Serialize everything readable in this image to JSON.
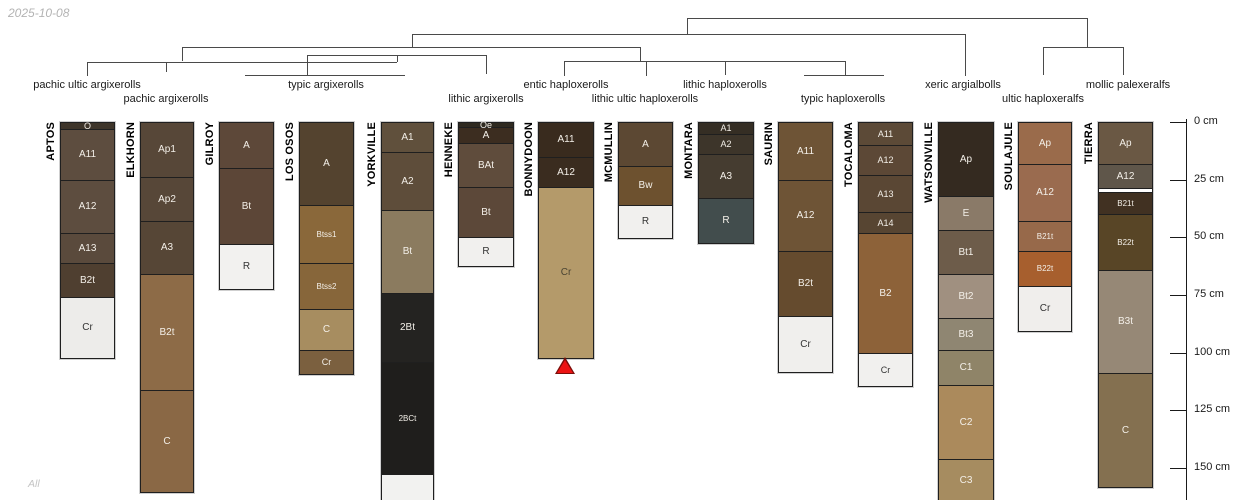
{
  "meta": {
    "date": "2025-10-08",
    "footer": "All"
  },
  "chart_data": {
    "type": "soil-profile-dendrogram",
    "title": "",
    "depth_axis": {
      "unit": "cm",
      "tick_values_cm": [
        0,
        25,
        50,
        75,
        100,
        125,
        150
      ],
      "tick_labels": [
        "0 cm",
        "25 cm",
        "50 cm",
        "75 cm",
        "100 cm",
        "125 cm",
        "150 cm"
      ]
    },
    "taxa": [
      {
        "label": "pachic ultic argixerolls",
        "x": 87,
        "row": 1,
        "members": [
          "APTOS"
        ]
      },
      {
        "label": "pachic argixerolls",
        "x": 166,
        "row": 2,
        "members": [
          "ELKHORN"
        ]
      },
      {
        "label": "typic argixerolls",
        "x": 326,
        "row": 1,
        "members": [
          "GILROY",
          "LOS OSOS",
          "YORKVILLE"
        ]
      },
      {
        "label": "lithic argixerolls",
        "x": 486,
        "row": 2,
        "members": [
          "HENNEKE"
        ]
      },
      {
        "label": "entic haploxerolls",
        "x": 566,
        "row": 1,
        "members": [
          "BONNYDOON"
        ]
      },
      {
        "label": "lithic ultic haploxerolls",
        "x": 645,
        "row": 2,
        "members": [
          "MCMULLIN"
        ]
      },
      {
        "label": "lithic haploxerolls",
        "x": 725,
        "row": 1,
        "members": [
          "MONTARA"
        ]
      },
      {
        "label": "typic haploxerolls",
        "x": 843,
        "row": 2,
        "members": [
          "SAURIN",
          "TOCALOMA"
        ]
      },
      {
        "label": "xeric argialbolls",
        "x": 963,
        "row": 1,
        "members": [
          "WATSONVILLE"
        ]
      },
      {
        "label": "ultic haploxeralfs",
        "x": 1043,
        "row": 2,
        "members": [
          "SOULAJULE"
        ]
      },
      {
        "label": "mollic palexeralfs",
        "x": 1128,
        "row": 1,
        "members": [
          "TIERRA"
        ]
      }
    ],
    "dendrogram": {
      "line_color": "#4a4a4a",
      "segments": [
        [
          87,
          61.5,
          397,
          61.5
        ],
        [
          307,
          55,
          486,
          55
        ],
        [
          182,
          47.3,
          640,
          47.3
        ],
        [
          564,
          61.3,
          845,
          61.3
        ],
        [
          412,
          33.5,
          965,
          33.5
        ],
        [
          687,
          18,
          1087,
          18
        ],
        [
          1043,
          47,
          1123,
          47
        ],
        [
          245,
          74.5,
          405,
          74.5
        ],
        [
          804,
          75,
          884,
          75
        ],
        [
          87,
          61.5,
          87,
          76
        ],
        [
          166,
          61.5,
          166,
          72
        ],
        [
          307,
          55,
          307,
          74.5
        ],
        [
          397,
          55,
          397,
          61.5
        ],
        [
          486,
          55,
          486,
          74
        ],
        [
          182,
          47.3,
          182,
          61.5
        ],
        [
          640,
          47.3,
          640,
          61.3
        ],
        [
          564,
          61.3,
          564,
          76
        ],
        [
          646,
          61.3,
          646,
          76
        ],
        [
          725,
          61.3,
          725,
          75
        ],
        [
          845,
          61.3,
          845,
          75
        ],
        [
          412,
          33.5,
          412,
          47.3
        ],
        [
          965,
          33.5,
          965,
          76
        ],
        [
          687,
          18,
          687,
          33.5
        ],
        [
          1087,
          18,
          1087,
          47
        ],
        [
          1043,
          47,
          1043,
          75
        ],
        [
          1123,
          47,
          1123,
          75
        ]
      ]
    },
    "marker": {
      "shape": "triangle-up",
      "fill": "#ec1313",
      "edge": "#7a0e0a",
      "profile": "BONNYDOON",
      "x": 565,
      "y": 357
    },
    "profiles": [
      {
        "name": "APTOS",
        "x": 60,
        "width": 53,
        "clipped": false,
        "horizons": [
          {
            "label": "O",
            "top_cm": 0,
            "bottom_cm": 3,
            "color": "#3e352a",
            "font": 9
          },
          {
            "label": "A11",
            "top_cm": 3,
            "bottom_cm": 25,
            "color": "#5d4d3f"
          },
          {
            "label": "A12",
            "top_cm": 25,
            "bottom_cm": 48,
            "color": "#5d4d3f"
          },
          {
            "label": "A13",
            "top_cm": 48,
            "bottom_cm": 61,
            "color": "#5a4a3c"
          },
          {
            "label": "B2t",
            "top_cm": 61,
            "bottom_cm": 76,
            "color": "#4f3f30"
          },
          {
            "label": "Cr",
            "top_cm": 76,
            "bottom_cm": 102,
            "color": "#edecea",
            "text_color": "#333333"
          }
        ]
      },
      {
        "name": "ELKHORN",
        "x": 140,
        "width": 52,
        "clipped": false,
        "horizons": [
          {
            "label": "Ap1",
            "top_cm": 0,
            "bottom_cm": 24,
            "color": "#574738"
          },
          {
            "label": "Ap2",
            "top_cm": 24,
            "bottom_cm": 43,
            "color": "#574738"
          },
          {
            "label": "A3",
            "top_cm": 43,
            "bottom_cm": 66,
            "color": "#564636"
          },
          {
            "label": "B2t",
            "top_cm": 66,
            "bottom_cm": 116,
            "color": "#8d6b47"
          },
          {
            "label": "C",
            "top_cm": 116,
            "bottom_cm": 160,
            "color": "#8a6845"
          }
        ]
      },
      {
        "name": "GILROY",
        "x": 219,
        "width": 53,
        "clipped": false,
        "horizons": [
          {
            "label": "A",
            "top_cm": 0,
            "bottom_cm": 20,
            "color": "#5d4839"
          },
          {
            "label": "Bt",
            "top_cm": 20,
            "bottom_cm": 53,
            "color": "#5c4637"
          },
          {
            "label": "R",
            "top_cm": 53,
            "bottom_cm": 72,
            "color": "#f2f1ef",
            "text_color": "#333333"
          }
        ]
      },
      {
        "name": "LOS OSOS",
        "x": 299,
        "width": 53,
        "clipped": false,
        "horizons": [
          {
            "label": "A",
            "top_cm": 0,
            "bottom_cm": 36,
            "color": "#54432f"
          },
          {
            "label": "Btss1",
            "top_cm": 36,
            "bottom_cm": 61,
            "color": "#8a683a",
            "font": 8
          },
          {
            "label": "Btss2",
            "top_cm": 61,
            "bottom_cm": 81,
            "color": "#87663a",
            "font": 8
          },
          {
            "label": "C",
            "top_cm": 81,
            "bottom_cm": 99,
            "color": "#a78d60"
          },
          {
            "label": "Cr",
            "top_cm": 99,
            "bottom_cm": 109,
            "color": "#7b603f",
            "font": 9
          }
        ]
      },
      {
        "name": "YORKVILLE",
        "x": 381,
        "width": 51,
        "clipped": true,
        "horizons": [
          {
            "label": "A1",
            "top_cm": 0,
            "bottom_cm": 13,
            "color": "#60503c"
          },
          {
            "label": "A2",
            "top_cm": 13,
            "bottom_cm": 38,
            "color": "#5e4d3a"
          },
          {
            "label": "Bt",
            "top_cm": 38,
            "bottom_cm": 74,
            "color": "#8b7b5f"
          },
          {
            "label": "2Bt",
            "top_cm": 74,
            "bottom_cm": 104,
            "color": "#242321"
          },
          {
            "label": "2BCt",
            "top_cm": 104,
            "bottom_cm": 152.5,
            "color": "#1f1e1c",
            "font": 8
          },
          {
            "label": "",
            "top_cm": 152.5,
            "bottom_cm": 164,
            "color": "#f2f2f0"
          }
        ]
      },
      {
        "name": "HENNEKE",
        "x": 458,
        "width": 54,
        "clipped": false,
        "horizons": [
          {
            "label": "Oe",
            "top_cm": 0,
            "bottom_cm": 2,
            "color": "#2f2a20",
            "font": 9
          },
          {
            "label": "A",
            "top_cm": 2,
            "bottom_cm": 9,
            "color": "#3c2d20"
          },
          {
            "label": "BAt",
            "top_cm": 9,
            "bottom_cm": 28,
            "color": "#5f4c3c"
          },
          {
            "label": "Bt",
            "top_cm": 28,
            "bottom_cm": 50,
            "color": "#5c4839"
          },
          {
            "label": "R",
            "top_cm": 50,
            "bottom_cm": 62,
            "color": "#f1f0ee",
            "text_color": "#333333"
          }
        ]
      },
      {
        "name": "BONNYDOON",
        "x": 538,
        "width": 54,
        "clipped": false,
        "horizons": [
          {
            "label": "A11",
            "top_cm": 0,
            "bottom_cm": 15,
            "color": "#392b1e"
          },
          {
            "label": "A12",
            "top_cm": 15,
            "bottom_cm": 28,
            "color": "#3a2c1f"
          },
          {
            "label": "Cr",
            "top_cm": 28,
            "bottom_cm": 102,
            "color": "#b49a6a",
            "text_color": "#4a4433"
          }
        ]
      },
      {
        "name": "MCMULLIN",
        "x": 618,
        "width": 53,
        "clipped": false,
        "horizons": [
          {
            "label": "A",
            "top_cm": 0,
            "bottom_cm": 19,
            "color": "#5c4833"
          },
          {
            "label": "Bw",
            "top_cm": 19,
            "bottom_cm": 36,
            "color": "#6d512f"
          },
          {
            "label": "R",
            "top_cm": 36,
            "bottom_cm": 50,
            "color": "#f1f0ee",
            "text_color": "#333333"
          }
        ]
      },
      {
        "name": "MONTARA",
        "x": 698,
        "width": 54,
        "clipped": false,
        "horizons": [
          {
            "label": "A1",
            "top_cm": 0,
            "bottom_cm": 5,
            "color": "#352e24",
            "font": 9
          },
          {
            "label": "A2",
            "top_cm": 5,
            "bottom_cm": 14,
            "color": "#3d352a",
            "font": 9
          },
          {
            "label": "A3",
            "top_cm": 14,
            "bottom_cm": 33,
            "color": "#453c30"
          },
          {
            "label": "R",
            "top_cm": 33,
            "bottom_cm": 52,
            "color": "#424d4d"
          }
        ]
      },
      {
        "name": "SAURIN",
        "x": 778,
        "width": 53,
        "clipped": false,
        "horizons": [
          {
            "label": "A11",
            "top_cm": 0,
            "bottom_cm": 25,
            "color": "#6e5436"
          },
          {
            "label": "A12",
            "top_cm": 25,
            "bottom_cm": 56,
            "color": "#6e5436"
          },
          {
            "label": "B2t",
            "top_cm": 56,
            "bottom_cm": 84,
            "color": "#654b2e"
          },
          {
            "label": "Cr",
            "top_cm": 84,
            "bottom_cm": 108,
            "color": "#f0efed",
            "text_color": "#333333"
          }
        ]
      },
      {
        "name": "TOCALOMA",
        "x": 858,
        "width": 53,
        "clipped": false,
        "horizons": [
          {
            "label": "A11",
            "top_cm": 0,
            "bottom_cm": 10,
            "color": "#5c4a37",
            "font": 9
          },
          {
            "label": "A12",
            "top_cm": 10,
            "bottom_cm": 23,
            "color": "#5c4836",
            "font": 9
          },
          {
            "label": "A13",
            "top_cm": 23,
            "bottom_cm": 39,
            "color": "#5a4734",
            "font": 9
          },
          {
            "label": "A14",
            "top_cm": 39,
            "bottom_cm": 48,
            "color": "#574532",
            "font": 9
          },
          {
            "label": "B2",
            "top_cm": 48,
            "bottom_cm": 100,
            "color": "#8d6239"
          },
          {
            "label": "Cr",
            "top_cm": 100,
            "bottom_cm": 114,
            "color": "#f1f0ee",
            "text_color": "#333333",
            "font": 9
          }
        ]
      },
      {
        "name": "WATSONVILLE",
        "x": 938,
        "width": 54,
        "clipped": true,
        "horizons": [
          {
            "label": "Ap",
            "top_cm": 0,
            "bottom_cm": 32,
            "color": "#342a20"
          },
          {
            "label": "E",
            "top_cm": 32,
            "bottom_cm": 47,
            "color": "#8a7a68"
          },
          {
            "label": "Bt1",
            "top_cm": 47,
            "bottom_cm": 66,
            "color": "#6d5c4a"
          },
          {
            "label": "Bt2",
            "top_cm": 66,
            "bottom_cm": 85,
            "color": "#a09080"
          },
          {
            "label": "Bt3",
            "top_cm": 85,
            "bottom_cm": 99,
            "color": "#8f8672"
          },
          {
            "label": "C1",
            "top_cm": 99,
            "bottom_cm": 114,
            "color": "#8f8468"
          },
          {
            "label": "C2",
            "top_cm": 114,
            "bottom_cm": 146,
            "color": "#ab8a5c"
          },
          {
            "label": "C3",
            "top_cm": 146,
            "bottom_cm": 164,
            "color": "#a68c60"
          }
        ]
      },
      {
        "name": "SOULAJULE",
        "x": 1018,
        "width": 52,
        "clipped": false,
        "horizons": [
          {
            "label": "Ap",
            "top_cm": 0,
            "bottom_cm": 18,
            "color": "#9a6b4b"
          },
          {
            "label": "A12",
            "top_cm": 18,
            "bottom_cm": 43,
            "color": "#9a6b4f"
          },
          {
            "label": "B21t",
            "top_cm": 43,
            "bottom_cm": 56,
            "color": "#97694a",
            "font": 8
          },
          {
            "label": "B22t",
            "top_cm": 56,
            "bottom_cm": 71,
            "color": "#a75f2e",
            "font": 8
          },
          {
            "label": "Cr",
            "top_cm": 71,
            "bottom_cm": 90,
            "color": "#f0eeec",
            "text_color": "#333333"
          }
        ]
      },
      {
        "name": "TIERRA",
        "x": 1098,
        "width": 53,
        "clipped": false,
        "horizons": [
          {
            "label": "Ap",
            "top_cm": 0,
            "bottom_cm": 18,
            "color": "#6a5844"
          },
          {
            "label": "A12",
            "top_cm": 18,
            "bottom_cm": 28.5,
            "color": "#5f564a"
          },
          {
            "label": "",
            "top_cm": 28.5,
            "bottom_cm": 30.5,
            "color": "#ffffff"
          },
          {
            "label": "B21t",
            "top_cm": 30.5,
            "bottom_cm": 40,
            "color": "#413122",
            "font": 8
          },
          {
            "label": "B22t",
            "top_cm": 40,
            "bottom_cm": 64,
            "color": "#584526",
            "font": 8
          },
          {
            "label": "B3t",
            "top_cm": 64,
            "bottom_cm": 109,
            "color": "#968876"
          },
          {
            "label": "C",
            "top_cm": 109,
            "bottom_cm": 158,
            "color": "#847050"
          }
        ]
      }
    ]
  }
}
